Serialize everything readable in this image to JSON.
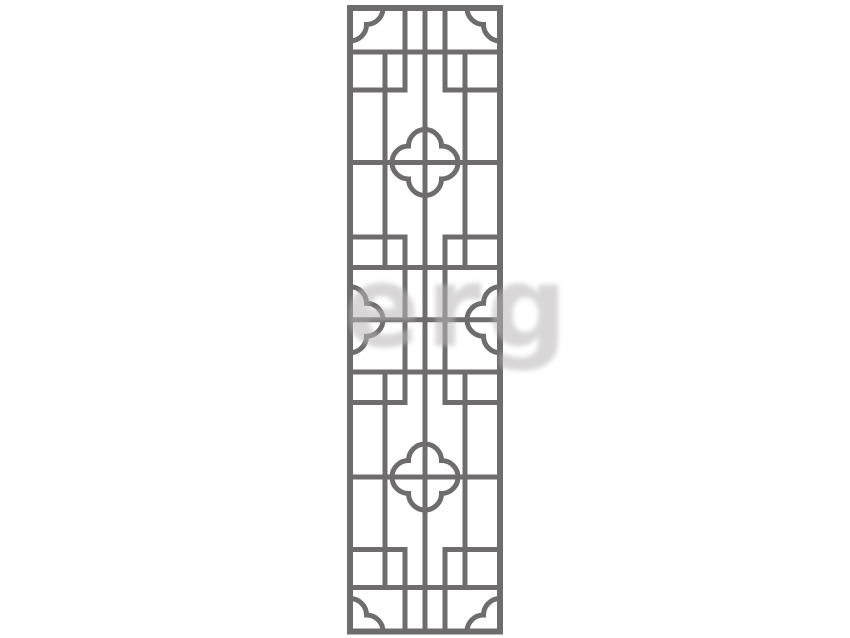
{
  "canvas": {
    "width": 850,
    "height": 638,
    "background": "#ffffff"
  },
  "illustration": {
    "subject": "chinese-lattice-window-panel",
    "style": "outline vector ornament, symmetric"
  },
  "colors": {
    "lattice_stroke": "#6e6c6c",
    "panel_fill": "#ffffff",
    "watermark": "#b9b6b6"
  },
  "watermark": {
    "text": "erg",
    "opacity": 0.55
  },
  "lattice": {
    "color": "#6e6c6c",
    "stroke": 5,
    "lobe_radius": 16.5,
    "frame": {
      "left": 350,
      "right": 500,
      "top": 8,
      "bottom": 631.5,
      "stroke": 6
    },
    "verticals": [
      {
        "name": "center",
        "x": 425,
        "spans": [
          [
            5,
            634.5
          ]
        ]
      },
      {
        "name": "inner-left",
        "x": 405,
        "spans": [
          [
            5,
            92.5
          ],
          [
            234.5,
            405
          ],
          [
            547,
            634.5
          ]
        ]
      },
      {
        "name": "inner-right",
        "x": 445,
        "spans": [
          [
            5,
            92.5
          ],
          [
            234.5,
            405
          ],
          [
            547,
            634.5
          ]
        ]
      },
      {
        "name": "outer-left",
        "x": 385,
        "spans": [
          [
            49.5,
            270
          ],
          [
            369.5,
            590
          ]
        ]
      },
      {
        "name": "outer-right",
        "x": 465,
        "spans": [
          [
            49.5,
            270
          ],
          [
            369.5,
            590
          ]
        ]
      }
    ],
    "rails": [
      {
        "name": "rail-1",
        "y": 52,
        "segs": [
          [
            347,
            503
          ]
        ]
      },
      {
        "name": "rail-2",
        "y": 90,
        "segs": [
          [
            347,
            407.5
          ],
          [
            442.5,
            503
          ]
        ]
      },
      {
        "name": "rail-3",
        "y": 162.5,
        "segs": [
          [
            347,
            503
          ]
        ]
      },
      {
        "name": "rail-4",
        "y": 237,
        "segs": [
          [
            347,
            407.5
          ],
          [
            442.5,
            503
          ]
        ]
      },
      {
        "name": "rail-5",
        "y": 267.5,
        "segs": [
          [
            347,
            503
          ]
        ]
      },
      {
        "name": "rail-6",
        "y": 319.75,
        "segs": [
          [
            347,
            503
          ]
        ]
      },
      {
        "name": "rail-7",
        "y": 372,
        "segs": [
          [
            347,
            503
          ]
        ]
      },
      {
        "name": "rail-8",
        "y": 402.5,
        "segs": [
          [
            347,
            407.5
          ],
          [
            442.5,
            503
          ]
        ]
      },
      {
        "name": "rail-9",
        "y": 477,
        "segs": [
          [
            347,
            503
          ]
        ]
      },
      {
        "name": "rail-10",
        "y": 549.5,
        "segs": [
          [
            347,
            407.5
          ],
          [
            442.5,
            503
          ]
        ]
      },
      {
        "name": "rail-11",
        "y": 587.5,
        "segs": [
          [
            347,
            503
          ]
        ]
      }
    ],
    "quatrefoils": [
      {
        "cx": 425,
        "cy": 162.5
      },
      {
        "cx": 425,
        "cy": 477
      }
    ],
    "half_quatrefoils": [
      {
        "x": 350,
        "cy": 319.75,
        "bulge": "right"
      },
      {
        "x": 500,
        "cy": 319.75,
        "bulge": "left"
      }
    ],
    "corner_brackets": [
      {
        "x": 350,
        "y": 8,
        "pos": "tl"
      },
      {
        "x": 500,
        "y": 8,
        "pos": "tr"
      },
      {
        "x": 350,
        "y": 631.5,
        "pos": "bl"
      },
      {
        "x": 500,
        "y": 631.5,
        "pos": "br"
      }
    ]
  }
}
